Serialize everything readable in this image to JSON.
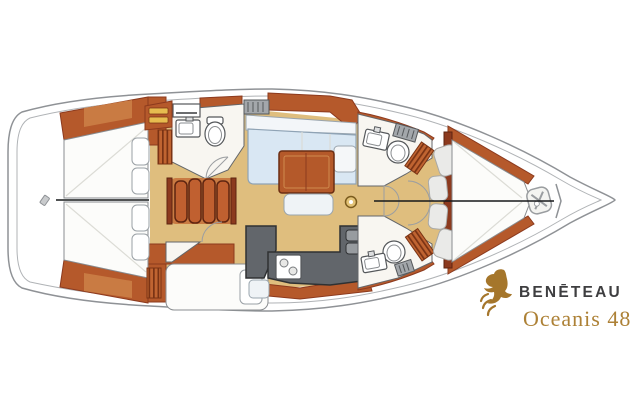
{
  "brand": {
    "logo_icon": "seahorse-icon",
    "name": "BENĒTEAU",
    "model": "Oceanis 48"
  },
  "colors": {
    "hull_outline": "#8F9296",
    "wood_trim": "#B5592B",
    "wood_trim_light": "#C97B43",
    "wood_dark": "#8C3A1E",
    "floor": "#DFBE7E",
    "room_floor": "#F8F6F1",
    "settee": "#D9E7F3",
    "galley_counter": "#62666B",
    "berth": "#FCFCFA",
    "cushion": "#EAEAE8",
    "mast_gold": "#E2C276",
    "brand_gold": "#A5762B",
    "brand_text": "#3E3E40",
    "model_text": "#AD8136"
  },
  "diagram": {
    "type": "yacht-interior-floor-plan",
    "orientation": "bow-right-stern-left",
    "areas": [
      {
        "id": "swim-platform",
        "features": [
          "transom-step-icon"
        ]
      },
      {
        "id": "aft-cabin-starboard",
        "features": [
          "double-berth",
          "two-pillows"
        ]
      },
      {
        "id": "aft-cabin-port",
        "features": [
          "double-berth",
          "pillow",
          "hanging-locker"
        ]
      },
      {
        "id": "aft-head",
        "features": [
          "toilet",
          "washbasin",
          "vanity",
          "laundry-locker",
          "hanging-locker",
          "door"
        ]
      },
      {
        "id": "companionway",
        "features": [
          "four-steps"
        ]
      },
      {
        "id": "saloon",
        "features": [
          "l-shaped-settee",
          "table",
          "bench-seat",
          "mast-post"
        ]
      },
      {
        "id": "galley",
        "features": [
          "two-burner-stove",
          "double-sink",
          "l-shaped-counter"
        ]
      },
      {
        "id": "nav-station",
        "features": [
          "chart-desk",
          "seat"
        ]
      },
      {
        "id": "forward-head-starboard",
        "features": [
          "toilet",
          "washbasin",
          "shelf",
          "hanging-locker",
          "door"
        ]
      },
      {
        "id": "forward-head-port",
        "features": [
          "toilet",
          "washbasin",
          "shelf",
          "hanging-locker",
          "door"
        ]
      },
      {
        "id": "forward-cabin",
        "features": [
          "v-berth",
          "four-seat-cushions",
          "wardrobe"
        ]
      },
      {
        "id": "anchor-locker",
        "features": [
          "windlass-icon"
        ]
      }
    ]
  }
}
